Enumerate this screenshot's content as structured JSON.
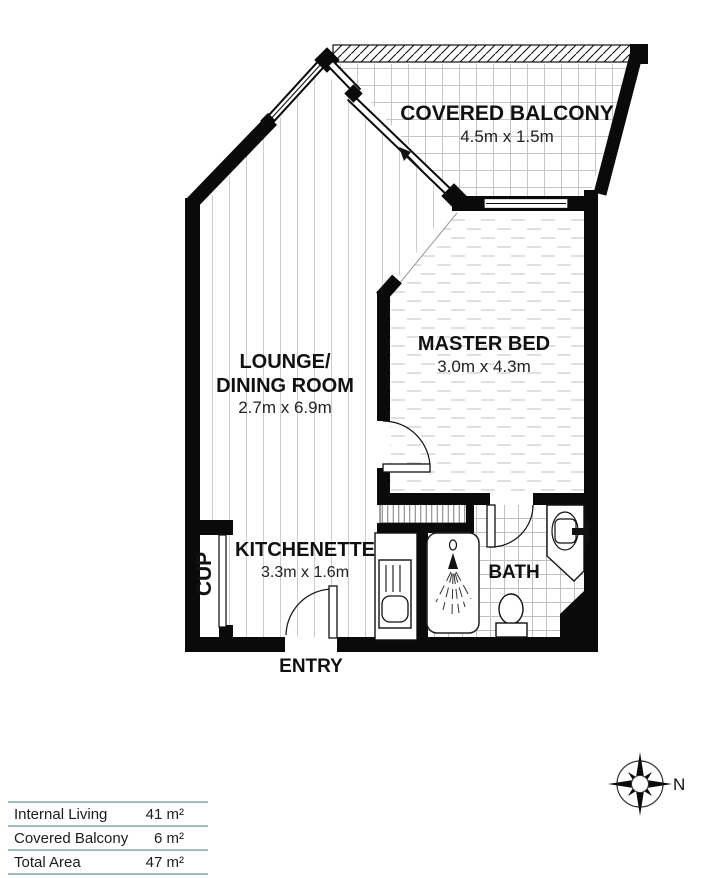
{
  "plan": {
    "rooms": {
      "balcony": {
        "name": "COVERED BALCONY",
        "dims": "4.5m x 1.5m"
      },
      "lounge": {
        "name_line1": "LOUNGE/",
        "name_line2": "DINING ROOM",
        "dims": "2.7m x 6.9m"
      },
      "master": {
        "name": "MASTER BED",
        "dims": "3.0m x 4.3m"
      },
      "kitchenette": {
        "name": "KITCHENETTE",
        "dims": "3.3m x 1.6m"
      },
      "bath": {
        "name": "BATH"
      },
      "cupboard": {
        "name": "CUP"
      },
      "entry": {
        "name": "ENTRY"
      }
    },
    "compass": {
      "north_label": "N"
    }
  },
  "legend": {
    "rows": [
      {
        "label": "Internal Living",
        "value": "41 m²"
      },
      {
        "label": "Covered Balcony",
        "value": "6 m²"
      },
      {
        "label": "Total Area",
        "value": "47 m²"
      }
    ]
  },
  "colors": {
    "wall": "#0a0a0a",
    "floor_pattern": "#c8c8c8",
    "legend_line": "#a3bac2"
  }
}
